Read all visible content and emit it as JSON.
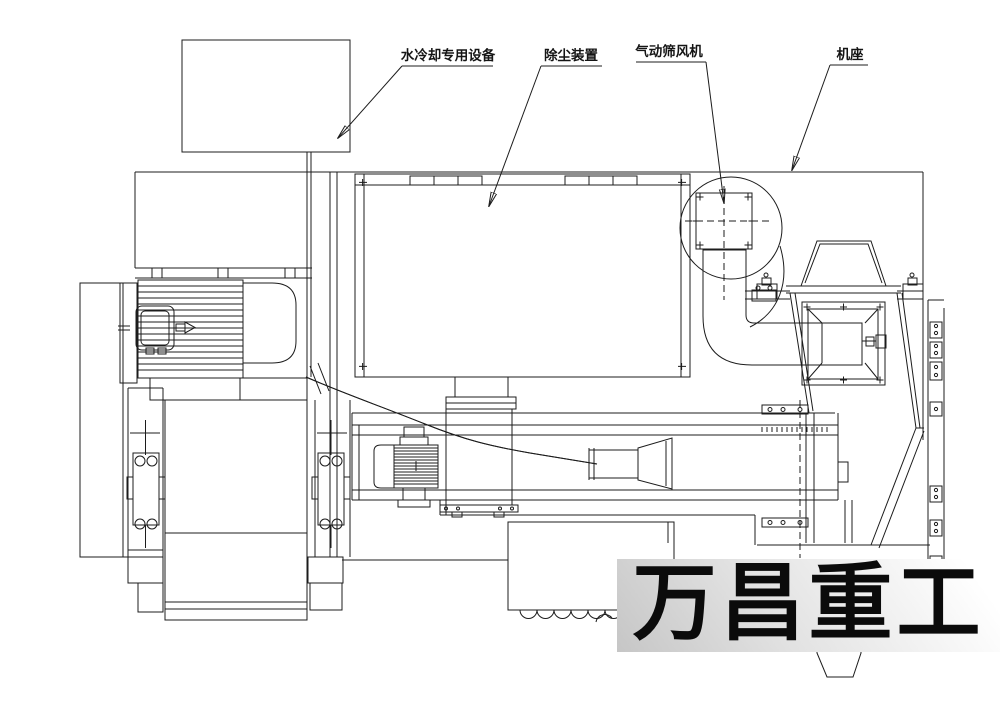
{
  "drawing": {
    "title_context": "sand-mill pneumatic screening machine assembly drawing",
    "callouts": [
      {
        "id": "water-cooling-unit",
        "text": "水冷却专用设备"
      },
      {
        "id": "dust-collector",
        "text": "除尘装置"
      },
      {
        "id": "pneumatic-sieve-fan",
        "text": "气动筛风机"
      },
      {
        "id": "machine-base",
        "text": "机座"
      }
    ],
    "watermark": {
      "text": "万昌重工"
    },
    "colors": {
      "line": "#1c1c1c",
      "background": "#ffffff",
      "watermark": "#0b0b0b",
      "band_from": "#c6c6c6",
      "band_to": "#ffffff"
    }
  }
}
